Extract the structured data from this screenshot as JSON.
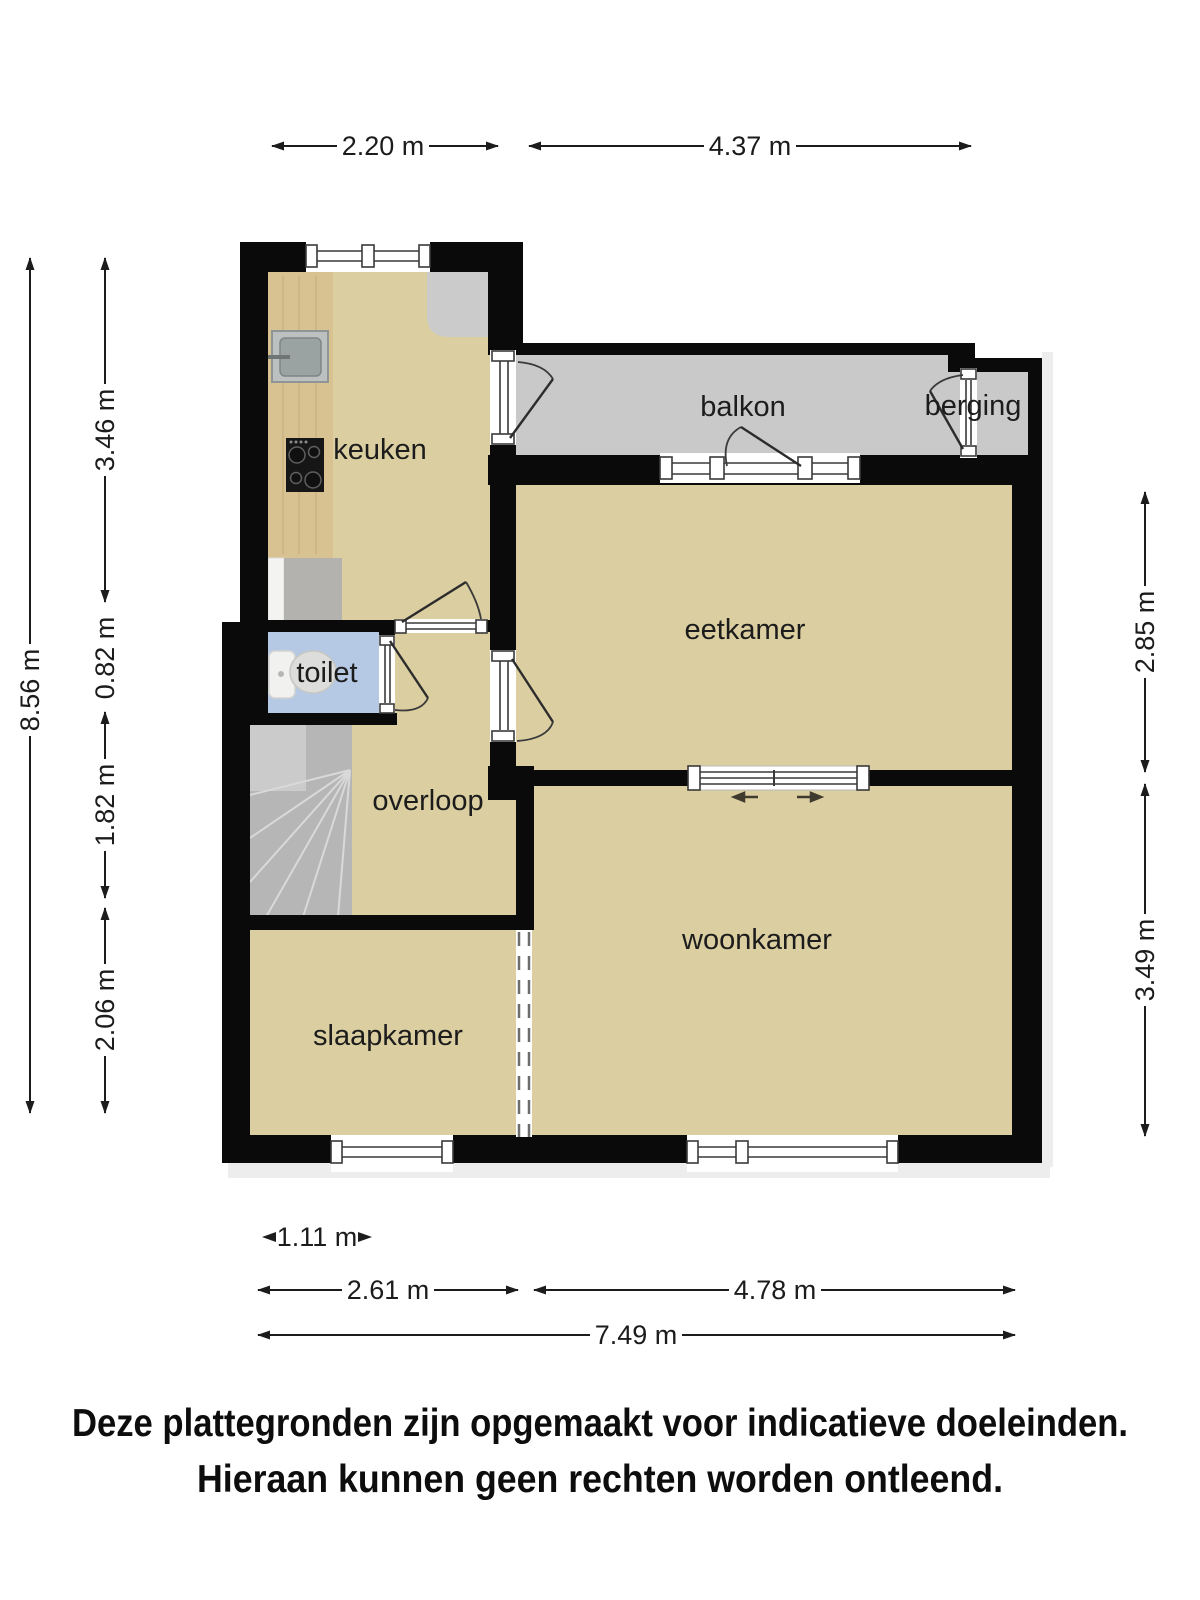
{
  "plan": {
    "rooms": [
      {
        "id": "keuken",
        "label": "keuken"
      },
      {
        "id": "balkon",
        "label": "balkon"
      },
      {
        "id": "berging",
        "label": "berging"
      },
      {
        "id": "eetkamer",
        "label": "eetkamer"
      },
      {
        "id": "toilet",
        "label": "toilet"
      },
      {
        "id": "overloop",
        "label": "overloop"
      },
      {
        "id": "woonkamer",
        "label": "woonkamer"
      },
      {
        "id": "slaapkamer",
        "label": "slaapkamer"
      }
    ],
    "dimensions": {
      "top": [
        "2.20 m",
        "4.37 m"
      ],
      "left": [
        "8.56 m",
        "3.46 m",
        "0.82 m",
        "1.82 m",
        "2.06 m"
      ],
      "right": [
        "2.85 m",
        "3.49 m"
      ],
      "bottom": [
        "1.11 m",
        "2.61 m",
        "4.78 m",
        "7.49 m"
      ]
    },
    "disclaimer": [
      "Deze plattegronden zijn opgemaakt voor indicatieve doeleinden.",
      "Hieraan kunnen geen rechten worden ontleend."
    ],
    "colors": {
      "ink": "#1c1c1c",
      "wall": "#0a0a0a",
      "floor": "#dbcea0",
      "balcony": "#c9c9c9",
      "toiletFloor": "#b5c8e4",
      "stairs": "#b6b6b6",
      "stairsLight": "#cbcbcb",
      "tread": "#d9d9d9",
      "counter": "#d8c292",
      "grain": "#c6ad7c",
      "sinkOuter": "#bcc0c0",
      "sinkInner": "#9aa2a2",
      "cooktop": "#161616",
      "applianceGray": "#b4b2af",
      "applianceWhite": "#f3f3f1",
      "cabinet": "#cbcbcb",
      "shadow": "#ededed",
      "sliderArrow": "#3f3b2e"
    }
  }
}
